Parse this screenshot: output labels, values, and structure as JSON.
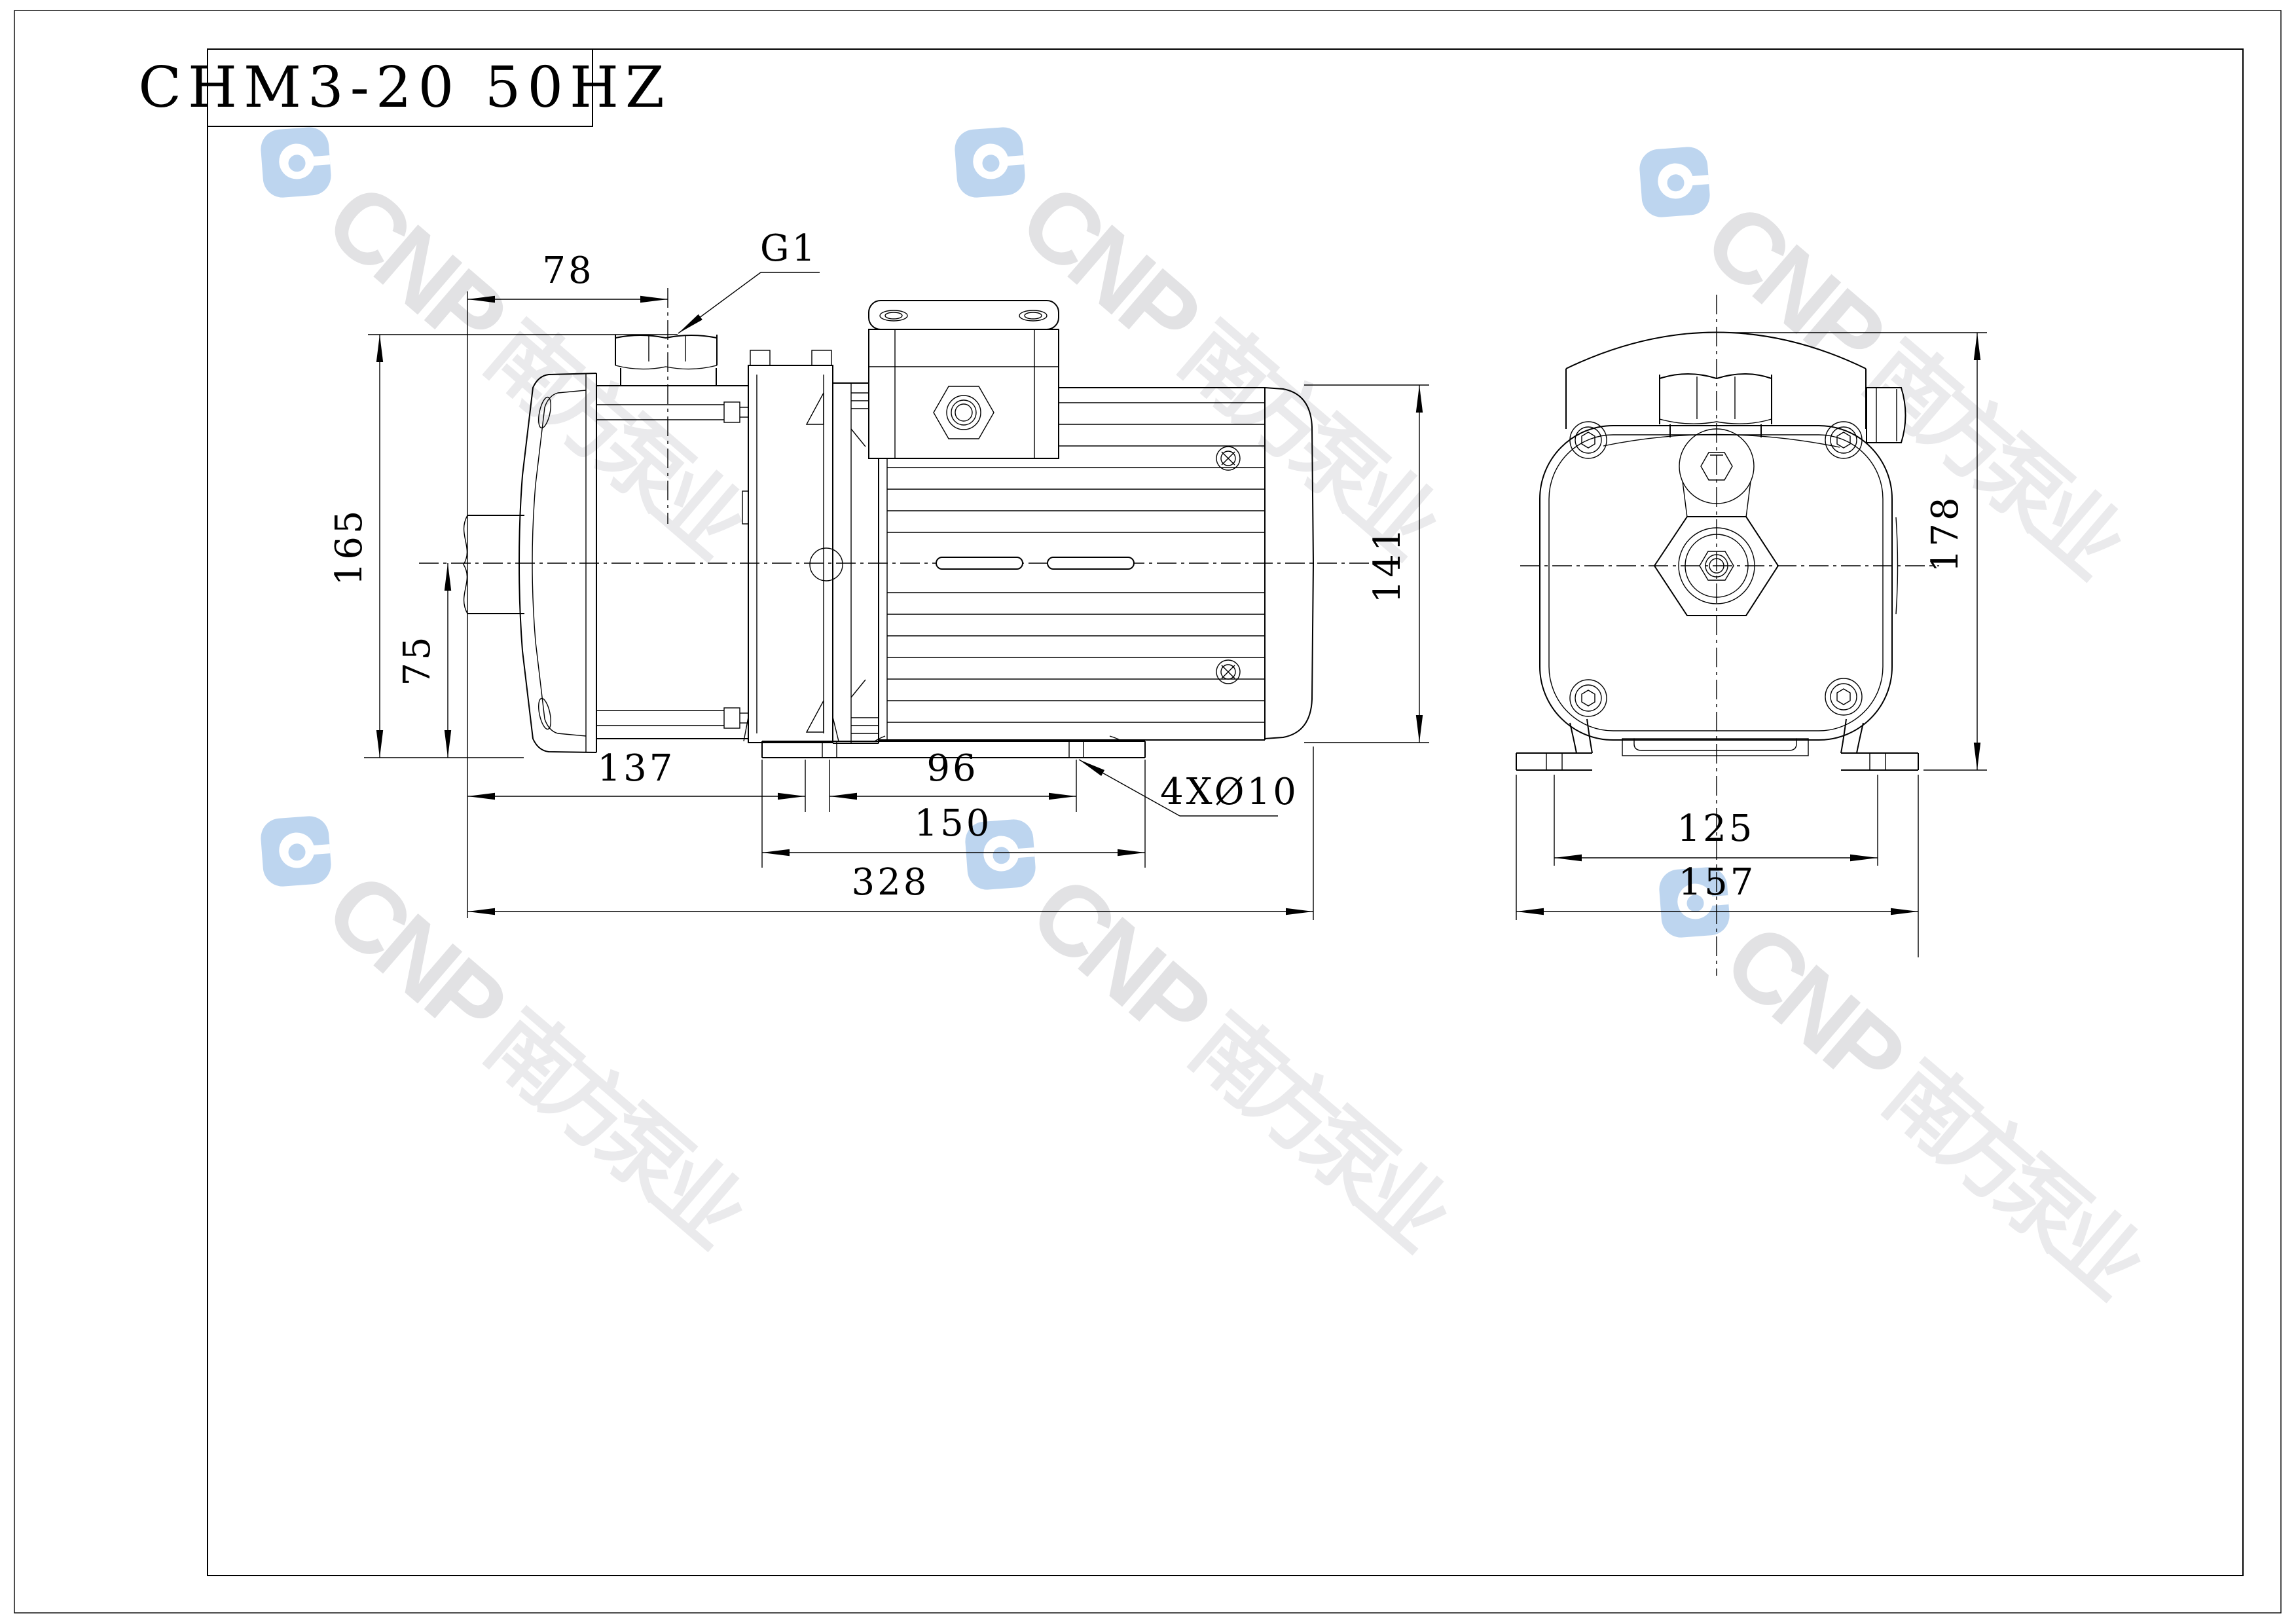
{
  "title": {
    "model": "CHM3-20 50HZ"
  },
  "watermark": {
    "brand": [
      "C",
      "N",
      "P"
    ],
    "name": [
      "南",
      "方",
      "泵",
      "业"
    ],
    "logo_color": "#bdd5ef",
    "brand_color": "#e2e2e4",
    "name_color": "#eaeaec"
  },
  "drawing": {
    "line_color": "#000000",
    "side_view": {
      "dims": {
        "suction_port_offset": "78",
        "suction_thread": "G1",
        "total_height": "165",
        "centerline_height": "75",
        "pump_length": "137",
        "foot_bolt_span": "96",
        "base_length": "150",
        "total_length": "328",
        "base_holes": "4XØ10",
        "motor_diameter": "141"
      }
    },
    "end_view": {
      "dims": {
        "total_height": "178",
        "foot_bolt_span": "125",
        "base_width": "157"
      }
    }
  }
}
